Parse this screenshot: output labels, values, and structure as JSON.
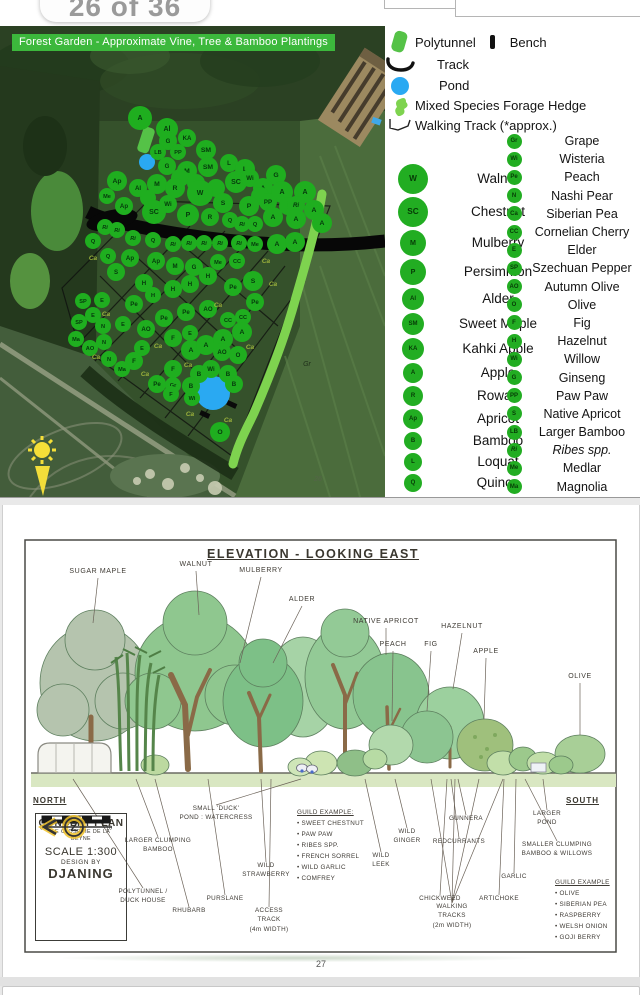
{
  "viewer": {
    "page_indicator": "26 of 36",
    "page_number": "27"
  },
  "map": {
    "title": "Forest Garden - Approximate Vine, Tree & Bamboo Plantings",
    "colors": {
      "tree_circle": "#1fae1f",
      "pond": "#2aa9f2",
      "hedge": "#7ed34f",
      "banner": "#3cb83c",
      "track": "#070707",
      "sun": "#f5df38"
    },
    "legend": {
      "features": [
        {
          "icon": "polytunnel-icon",
          "name": "Polytunnel"
        },
        {
          "icon": "bench-icon",
          "name": "Bench"
        },
        {
          "icon": "track-icon",
          "name": "Track"
        },
        {
          "icon": "pond-icon",
          "name": "Pond"
        },
        {
          "icon": "hedge-icon",
          "name": "Mixed Species Forage Hedge"
        },
        {
          "icon": "walking-track-icon",
          "name": "Walking Track (*approx.)"
        }
      ],
      "species_large": [
        {
          "code": "W",
          "name": "Walnut",
          "r": 15
        },
        {
          "code": "SC",
          "name": "Chestnut",
          "r": 15
        },
        {
          "code": "M",
          "name": "Mulberry",
          "r": 13
        },
        {
          "code": "P",
          "name": "Persimmon",
          "r": 13
        },
        {
          "code": "Al",
          "name": "Alder",
          "r": 11
        },
        {
          "code": "SM",
          "name": "Sweet Maple",
          "r": 11
        },
        {
          "code": "KA",
          "name": "Kahki Apple",
          "r": 11
        },
        {
          "code": "A",
          "name": "Apple",
          "r": 10
        },
        {
          "code": "R",
          "name": "Rowan",
          "r": 10
        },
        {
          "code": "Ap",
          "name": "Apricot",
          "r": 10
        },
        {
          "code": "B",
          "name": "Bamboo",
          "r": 9
        },
        {
          "code": "L",
          "name": "Loquat",
          "r": 9
        },
        {
          "code": "Q",
          "name": "Quince",
          "r": 9
        }
      ],
      "species_small": [
        {
          "code": "Gr",
          "name": "Grape"
        },
        {
          "code": "Wi",
          "name": "Wisteria"
        },
        {
          "code": "Pe",
          "name": "Peach"
        },
        {
          "code": "N",
          "name": "Nashi Pear"
        },
        {
          "code": "Ca",
          "name": "Siberian Pea"
        },
        {
          "code": "CC",
          "name": "Cornelian Cherry"
        },
        {
          "code": "E",
          "name": "Elder"
        },
        {
          "code": "SP",
          "name": "Szechuan Pepper"
        },
        {
          "code": "AO",
          "name": "Autumn Olive"
        },
        {
          "code": "O",
          "name": "Olive"
        },
        {
          "code": "F",
          "name": "Fig"
        },
        {
          "code": "H",
          "name": "Hazelnut"
        },
        {
          "code": "Wi",
          "name": "Willow"
        },
        {
          "code": "G",
          "name": "Ginseng"
        },
        {
          "code": "PP",
          "name": "Paw Paw"
        },
        {
          "code": "S",
          "name": "Native Apricot"
        },
        {
          "code": "LB",
          "name": "Larger Bamboo"
        },
        {
          "code": "Ri",
          "name": "Ribes spp.",
          "italic": 1
        },
        {
          "code": "Me",
          "name": "Medlar"
        },
        {
          "code": "Ma",
          "name": "Magnolia"
        }
      ]
    },
    "trees": [
      {
        "l": "A",
        "x": 140,
        "y": 92,
        "r": 12
      },
      {
        "l": "Al",
        "x": 167,
        "y": 103,
        "r": 11
      },
      {
        "l": "G",
        "x": 168,
        "y": 115,
        "r": 9
      },
      {
        "l": "KA",
        "x": 187,
        "y": 112,
        "r": 9
      },
      {
        "l": "LB",
        "x": 158,
        "y": 126,
        "r": 8
      },
      {
        "l": "PP",
        "x": 178,
        "y": 126,
        "r": 8
      },
      {
        "l": "SM",
        "x": 206,
        "y": 124,
        "r": 10
      },
      {
        "l": "G",
        "x": 167,
        "y": 140,
        "r": 9
      },
      {
        "l": "M",
        "x": 187,
        "y": 145,
        "r": 10
      },
      {
        "l": "SM",
        "x": 208,
        "y": 141,
        "r": 10
      },
      {
        "l": "L",
        "x": 229,
        "y": 137,
        "r": 9
      },
      {
        "l": "L",
        "x": 245,
        "y": 143,
        "r": 10
      },
      {
        "l": "SC",
        "x": 236,
        "y": 156,
        "r": 11
      },
      {
        "l": "Wi",
        "x": 250,
        "y": 152,
        "r": 9
      },
      {
        "l": "G",
        "x": 276,
        "y": 149,
        "r": 10
      },
      {
        "l": "A",
        "x": 263,
        "y": 162,
        "r": 10
      },
      {
        "l": "A",
        "x": 282,
        "y": 166,
        "r": 11
      },
      {
        "l": "A",
        "x": 305,
        "y": 166,
        "r": 11
      },
      {
        "l": "",
        "x": 180,
        "y": 152,
        "r": 9
      },
      {
        "l": "",
        "x": 216,
        "y": 162,
        "r": 9
      },
      {
        "l": "",
        "x": 260,
        "y": 170,
        "r": 9
      },
      {
        "l": "",
        "x": 288,
        "y": 180,
        "r": 9
      },
      {
        "l": "",
        "x": 148,
        "y": 172,
        "r": 8
      },
      {
        "l": "",
        "x": 196,
        "y": 157,
        "r": 9
      },
      {
        "l": "Ap",
        "x": 117,
        "y": 155,
        "r": 10
      },
      {
        "l": "Al",
        "x": 138,
        "y": 162,
        "r": 9
      },
      {
        "l": "M",
        "x": 157,
        "y": 158,
        "r": 10
      },
      {
        "l": "R",
        "x": 175,
        "y": 162,
        "r": 10
      },
      {
        "l": "W",
        "x": 200,
        "y": 167,
        "r": 13
      },
      {
        "l": "Me",
        "x": 107,
        "y": 170,
        "r": 8
      },
      {
        "l": "Ap",
        "x": 124,
        "y": 180,
        "r": 9
      },
      {
        "l": "SC",
        "x": 154,
        "y": 186,
        "r": 12
      },
      {
        "l": "Wi",
        "x": 168,
        "y": 178,
        "r": 9
      },
      {
        "l": "S",
        "x": 223,
        "y": 177,
        "r": 10
      },
      {
        "l": "P",
        "x": 188,
        "y": 189,
        "r": 11
      },
      {
        "l": "P",
        "x": 249,
        "y": 180,
        "r": 10
      },
      {
        "l": "PP",
        "x": 268,
        "y": 176,
        "r": 9
      },
      {
        "l": "Ri",
        "x": 296,
        "y": 179,
        "r": 9,
        "i": 1
      },
      {
        "l": "A",
        "x": 314,
        "y": 184,
        "r": 10
      },
      {
        "l": "R",
        "x": 210,
        "y": 191,
        "r": 9
      },
      {
        "l": "Q",
        "x": 230,
        "y": 194,
        "r": 8
      },
      {
        "l": "Ri",
        "x": 242,
        "y": 198,
        "r": 8,
        "i": 1
      },
      {
        "l": "Q",
        "x": 255,
        "y": 198,
        "r": 8
      },
      {
        "l": "A",
        "x": 273,
        "y": 191,
        "r": 10
      },
      {
        "l": "A",
        "x": 296,
        "y": 193,
        "r": 10
      },
      {
        "l": "A",
        "x": 322,
        "y": 197,
        "r": 10
      },
      {
        "l": "Ri",
        "x": 105,
        "y": 201,
        "r": 8,
        "i": 1
      },
      {
        "l": "Ri",
        "x": 117,
        "y": 204,
        "r": 8,
        "i": 1
      },
      {
        "l": "Q",
        "x": 93,
        "y": 215,
        "r": 8
      },
      {
        "l": "Ri",
        "x": 133,
        "y": 212,
        "r": 8,
        "i": 1
      },
      {
        "l": "Q",
        "x": 153,
        "y": 214,
        "r": 8
      },
      {
        "l": "Ri",
        "x": 173,
        "y": 218,
        "r": 8,
        "i": 1
      },
      {
        "l": "Ri",
        "x": 189,
        "y": 217,
        "r": 8,
        "i": 1
      },
      {
        "l": "Ri",
        "x": 204,
        "y": 217,
        "r": 8,
        "i": 1
      },
      {
        "l": "Ri",
        "x": 220,
        "y": 217,
        "r": 8,
        "i": 1
      },
      {
        "l": "Ri",
        "x": 239,
        "y": 217,
        "r": 8,
        "i": 1
      },
      {
        "l": "Me",
        "x": 255,
        "y": 218,
        "r": 8
      },
      {
        "l": "A",
        "x": 277,
        "y": 218,
        "r": 10
      },
      {
        "l": "A",
        "x": 295,
        "y": 216,
        "r": 10
      },
      {
        "l": "Ca",
        "x": 93,
        "y": 232,
        "t": 1
      },
      {
        "l": "Q",
        "x": 108,
        "y": 230,
        "r": 8
      },
      {
        "l": "Ap",
        "x": 130,
        "y": 232,
        "r": 9
      },
      {
        "l": "S",
        "x": 116,
        "y": 246,
        "r": 9
      },
      {
        "l": "Ap",
        "x": 156,
        "y": 235,
        "r": 9
      },
      {
        "l": "M",
        "x": 175,
        "y": 240,
        "r": 9
      },
      {
        "l": "G",
        "x": 194,
        "y": 241,
        "r": 9
      },
      {
        "l": "Me",
        "x": 218,
        "y": 236,
        "r": 8
      },
      {
        "l": "CC",
        "x": 237,
        "y": 235,
        "r": 8
      },
      {
        "l": "Ca",
        "x": 266,
        "y": 235,
        "t": 1
      },
      {
        "l": "H",
        "x": 208,
        "y": 250,
        "r": 9
      },
      {
        "l": "S",
        "x": 253,
        "y": 255,
        "r": 10
      },
      {
        "l": "Ca",
        "x": 273,
        "y": 258,
        "t": 1
      },
      {
        "l": "H",
        "x": 144,
        "y": 257,
        "r": 9
      },
      {
        "l": "H",
        "x": 173,
        "y": 263,
        "r": 9
      },
      {
        "l": "H",
        "x": 190,
        "y": 258,
        "r": 9
      },
      {
        "l": "H",
        "x": 153,
        "y": 269,
        "r": 8
      },
      {
        "l": "Pe",
        "x": 233,
        "y": 261,
        "r": 9
      },
      {
        "l": "SP",
        "x": 83,
        "y": 275,
        "r": 8
      },
      {
        "l": "E",
        "x": 102,
        "y": 274,
        "r": 8
      },
      {
        "l": "Pe",
        "x": 134,
        "y": 278,
        "r": 9
      },
      {
        "l": "Pe",
        "x": 164,
        "y": 292,
        "r": 9
      },
      {
        "l": "Pe",
        "x": 186,
        "y": 286,
        "r": 9
      },
      {
        "l": "AO",
        "x": 208,
        "y": 283,
        "r": 9
      },
      {
        "l": "Ca",
        "x": 218,
        "y": 279,
        "t": 1
      },
      {
        "l": "CC",
        "x": 228,
        "y": 294,
        "r": 8
      },
      {
        "l": "CC",
        "x": 243,
        "y": 291,
        "r": 8
      },
      {
        "l": "Pe",
        "x": 255,
        "y": 276,
        "r": 9
      },
      {
        "l": "SP",
        "x": 79,
        "y": 296,
        "r": 8
      },
      {
        "l": "E",
        "x": 93,
        "y": 289,
        "r": 8
      },
      {
        "l": "Ca",
        "x": 106,
        "y": 288,
        "t": 1
      },
      {
        "l": "N",
        "x": 103,
        "y": 300,
        "r": 8
      },
      {
        "l": "E",
        "x": 123,
        "y": 298,
        "r": 8
      },
      {
        "l": "AO",
        "x": 146,
        "y": 303,
        "r": 9
      },
      {
        "l": "F",
        "x": 173,
        "y": 312,
        "r": 9
      },
      {
        "l": "E",
        "x": 190,
        "y": 307,
        "r": 8
      },
      {
        "l": "A",
        "x": 191,
        "y": 324,
        "r": 10
      },
      {
        "l": "A",
        "x": 206,
        "y": 319,
        "r": 10
      },
      {
        "l": "A",
        "x": 223,
        "y": 313,
        "r": 10
      },
      {
        "l": "A",
        "x": 242,
        "y": 306,
        "r": 10
      },
      {
        "l": "Ma",
        "x": 76,
        "y": 313,
        "r": 8
      },
      {
        "l": "AO",
        "x": 90,
        "y": 322,
        "r": 8
      },
      {
        "l": "N",
        "x": 104,
        "y": 316,
        "r": 8
      },
      {
        "l": "E",
        "x": 142,
        "y": 322,
        "r": 8
      },
      {
        "l": "Ca",
        "x": 158,
        "y": 320,
        "t": 1
      },
      {
        "l": "AO",
        "x": 222,
        "y": 326,
        "r": 9
      },
      {
        "l": "O",
        "x": 238,
        "y": 329,
        "r": 9
      },
      {
        "l": "Ca",
        "x": 250,
        "y": 321,
        "t": 1
      },
      {
        "l": "Ca",
        "x": 96,
        "y": 331,
        "t": 1
      },
      {
        "l": "N",
        "x": 109,
        "y": 333,
        "r": 8
      },
      {
        "l": "F",
        "x": 134,
        "y": 335,
        "r": 9
      },
      {
        "l": "Ma",
        "x": 122,
        "y": 343,
        "r": 8
      },
      {
        "l": "Ca",
        "x": 145,
        "y": 348,
        "t": 1
      },
      {
        "l": "F",
        "x": 173,
        "y": 343,
        "r": 9
      },
      {
        "l": "Ca",
        "x": 188,
        "y": 339,
        "t": 1
      },
      {
        "l": "B",
        "x": 199,
        "y": 348,
        "r": 9
      },
      {
        "l": "Wi",
        "x": 211,
        "y": 343,
        "r": 9
      },
      {
        "l": "B",
        "x": 228,
        "y": 348,
        "r": 9
      },
      {
        "l": "Pe",
        "x": 157,
        "y": 358,
        "r": 9
      },
      {
        "l": "Gr",
        "x": 173,
        "y": 359,
        "r": 8
      },
      {
        "l": "B",
        "x": 191,
        "y": 360,
        "r": 9
      },
      {
        "l": "B",
        "x": 234,
        "y": 358,
        "r": 9
      },
      {
        "l": "F",
        "x": 171,
        "y": 368,
        "r": 8
      },
      {
        "l": "Wi",
        "x": 192,
        "y": 372,
        "r": 8
      },
      {
        "l": "Ca",
        "x": 190,
        "y": 388,
        "t": 1
      },
      {
        "l": "Ca",
        "x": 228,
        "y": 394,
        "t": 1
      },
      {
        "l": "O",
        "x": 220,
        "y": 406,
        "r": 10
      }
    ],
    "field_labels": [
      {
        "l": "Gr",
        "x": 307,
        "y": 340,
        "c": "#20301b"
      },
      {
        "l": "26",
        "x": 318,
        "y": 455,
        "c": "#55644a"
      }
    ]
  },
  "elevation": {
    "title": "ELEVATION - LOOKING EAST",
    "north_label": "NORTH",
    "south_label": "SOUTH",
    "tree_labels": [
      {
        "text": "SUGAR MAPLE",
        "x": 95,
        "y": 63,
        "lx": 90,
        "ly": 118
      },
      {
        "text": "WALNUT",
        "x": 193,
        "y": 56,
        "lx": 196,
        "ly": 110
      },
      {
        "text": "MULBERRY",
        "x": 258,
        "y": 62,
        "lx": 237,
        "ly": 158
      },
      {
        "text": "ALDER",
        "x": 299,
        "y": 91,
        "lx": 270,
        "ly": 158
      },
      {
        "text": "NATIVE APRICOT",
        "x": 383,
        "y": 113,
        "lx": 383,
        "ly": 150
      },
      {
        "text": "HAZELNUT",
        "x": 459,
        "y": 118,
        "lx": 450,
        "ly": 184
      },
      {
        "text": "PEACH",
        "x": 390,
        "y": 136,
        "lx": 389,
        "ly": 216
      },
      {
        "text": "FIG",
        "x": 428,
        "y": 136,
        "lx": 424,
        "ly": 206
      },
      {
        "text": "APPLE",
        "x": 483,
        "y": 143,
        "lx": 481,
        "ly": 214
      },
      {
        "text": "OLIVE",
        "x": 577,
        "y": 168,
        "lx": 577,
        "ly": 230
      }
    ],
    "annotations": [
      {
        "lines": [
          "SMALL 'DUCK'",
          "POND : WATERCRESS"
        ],
        "x": 213,
        "y": 299,
        "tx": 298
      },
      {
        "lines": [
          "LARGER CLUMPING",
          "BAMBOO"
        ],
        "x": 155,
        "y": 331,
        "tx": 133
      },
      {
        "lines": [
          "POLYTUNNEL /",
          "DUCK HOUSE"
        ],
        "x": 140,
        "y": 382,
        "tx": 70
      },
      {
        "lines": [
          "RHUBARB"
        ],
        "x": 186,
        "y": 401,
        "tx": 152
      },
      {
        "lines": [
          "PURSLANE"
        ],
        "x": 222,
        "y": 389,
        "tx": 205
      },
      {
        "lines": [
          "WILD",
          "STRAWBERRY"
        ],
        "x": 263,
        "y": 356,
        "tx": 258
      },
      {
        "lines": [
          "ACCESS",
          "TRACK",
          "(4m WIDTH)"
        ],
        "x": 266,
        "y": 401,
        "tx": 268
      },
      {
        "lines": [
          "WILD",
          "LEEK"
        ],
        "x": 378,
        "y": 346,
        "tx": 362
      },
      {
        "lines": [
          "WILD",
          "GINGER"
        ],
        "x": 404,
        "y": 322,
        "tx": 392
      },
      {
        "lines": [
          "WALKING",
          "TRACKS",
          "(2m WIDTH)"
        ],
        "x": 449,
        "y": 397,
        "fan": [
          428,
          452,
          476,
          500
        ]
      },
      {
        "lines": [
          "CHICKWEED"
        ],
        "x": 437,
        "y": 389,
        "tx": 444
      },
      {
        "lines": [
          "ARTICHOKE"
        ],
        "x": 496,
        "y": 389,
        "tx": 501
      },
      {
        "lines": [
          "GARLIC"
        ],
        "x": 511,
        "y": 367,
        "tx": 513
      },
      {
        "lines": [
          "GUNNERA"
        ],
        "x": 463,
        "y": 309,
        "tx": 455
      },
      {
        "lines": [
          "REDCURRANTS"
        ],
        "x": 456,
        "y": 332,
        "tx": 448
      },
      {
        "lines": [
          "LARGER",
          "POND"
        ],
        "x": 544,
        "y": 304,
        "tx": 540
      },
      {
        "lines": [
          "SMALLER CLUMPING",
          "BAMBOO & WILLOWS"
        ],
        "x": 554,
        "y": 335,
        "tx": 522
      }
    ],
    "guild1": {
      "title": "GUILD EXAMPLE:",
      "items": [
        "SWEET CHESTNUT",
        "PAW PAW",
        "RIBES SPP.",
        "FRENCH SORREL",
        "WILD GARLIC",
        "COMFREY"
      ]
    },
    "guild2": {
      "title": "GUILD EXAMPLE",
      "items": [
        "OLIVE",
        "SIBERIAN PEA",
        "RASPBERRY",
        "WELSH ONION",
        "GOJI BERRY"
      ]
    },
    "concept_box": {
      "title": "CONCEPT PLAN",
      "sub1": "LE CLOSERIE DE LA",
      "sub2": "BEYNE",
      "scale": "SCALE 1:300",
      "scale_min": "0",
      "scale_max": "10",
      "design_by": "DESIGN BY",
      "designer": "DJANING"
    }
  }
}
